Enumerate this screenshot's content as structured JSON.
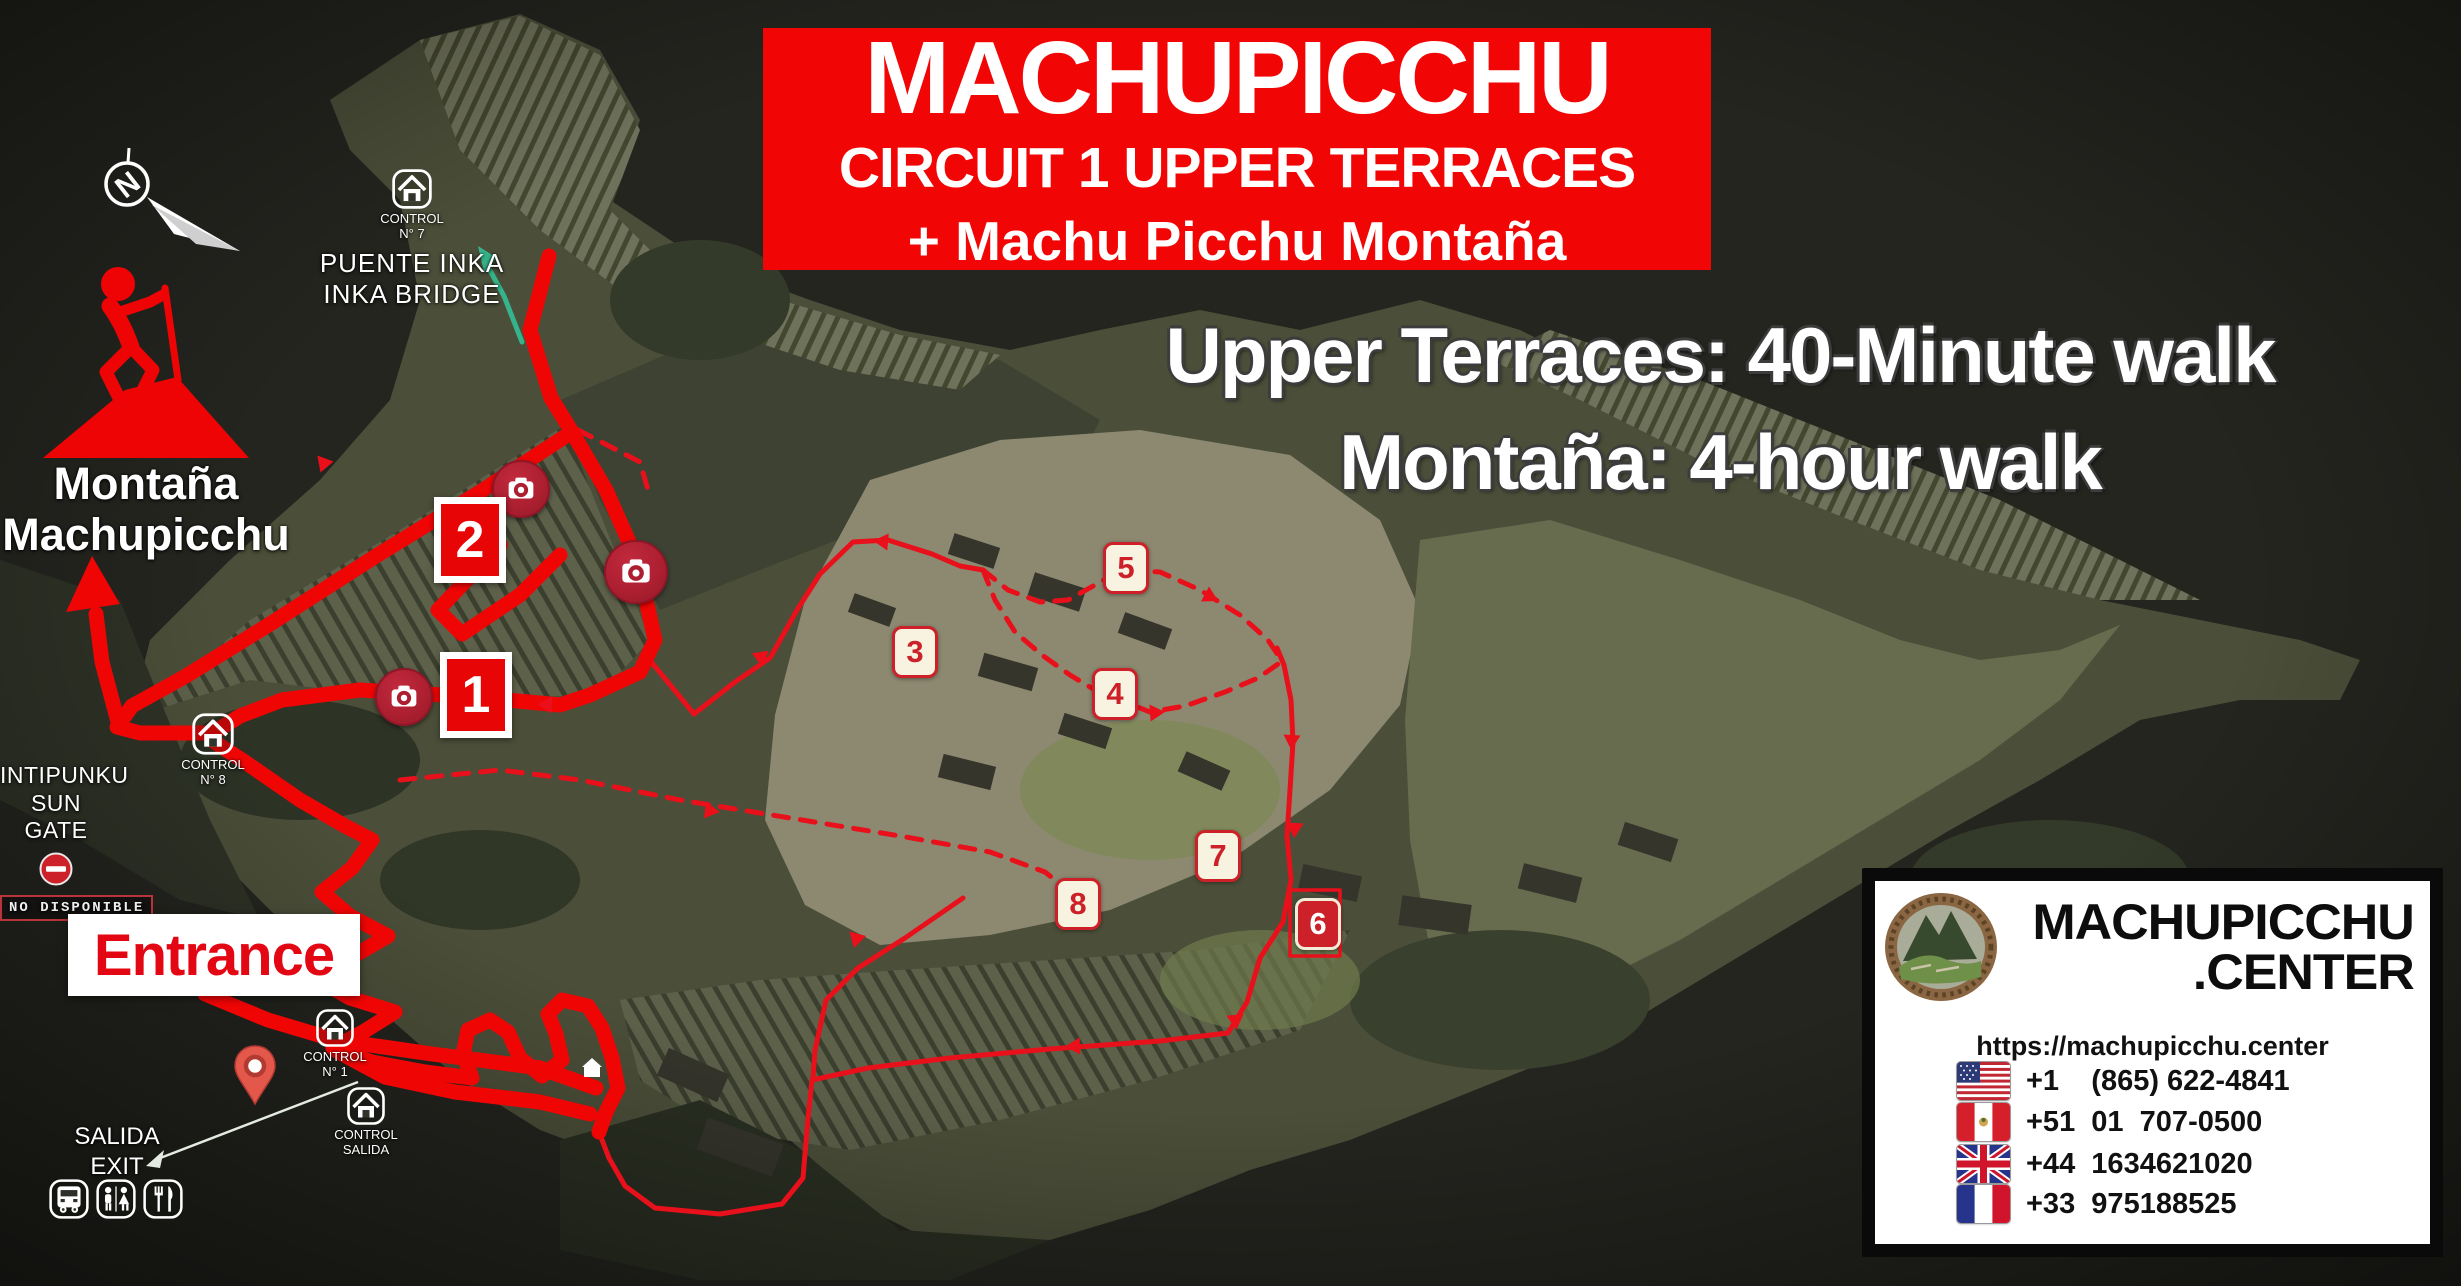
{
  "banner": {
    "title": "MACHUPICCHU",
    "subtitle": "CIRCUIT 1 UPPER TERRACES",
    "subtitle2": "+ Machu Picchu Montaña"
  },
  "walk_info": {
    "line1": "Upper Terraces: 40-Minute walk",
    "line2": "Montaña: 4-hour walk"
  },
  "compass": {
    "north_letter": "N"
  },
  "montana_peak": {
    "line1": "Montaña",
    "line2": "Machupicchu"
  },
  "inka_bridge": {
    "control_line1": "CONTROL",
    "control_line2": "N° 7",
    "name_line1": "PUENTE INKA",
    "name_line2": "INKA BRIDGE"
  },
  "sun_gate": {
    "name_line1": "INTIPUNKU",
    "name_line2": "SUN GATE",
    "status": "NO DISPONIBLE"
  },
  "control_8": {
    "line1": "CONTROL",
    "line2": "N° 8"
  },
  "control_1": {
    "line1": "CONTROL",
    "line2": "N° 1"
  },
  "control_salida": {
    "line1": "CONTROL",
    "line2": "SALIDA"
  },
  "entrance": {
    "label": "Entrance"
  },
  "exit": {
    "line1": "SALIDA",
    "line2": "EXIT"
  },
  "markers": [
    {
      "label": "1"
    },
    {
      "label": "2"
    },
    {
      "label": "3"
    },
    {
      "label": "4"
    },
    {
      "label": "5"
    },
    {
      "label": "6"
    },
    {
      "label": "7"
    },
    {
      "label": "8"
    }
  ],
  "facilities": {
    "icons": [
      "bus",
      "restrooms",
      "restaurant"
    ]
  },
  "info_box": {
    "brand_line1": "MACHUPICCHU",
    "brand_line2": ".CENTER",
    "url": "https://machupicchu.center",
    "phones": [
      {
        "flag": "usa",
        "number": "+1    (865) 622-4841"
      },
      {
        "flag": "peru",
        "number": "+51  01  707-0500"
      },
      {
        "flag": "uk",
        "number": "+44  1634621020"
      },
      {
        "flag": "france",
        "number": "+33  975188525"
      }
    ]
  },
  "colors": {
    "banner_red": "#f20505",
    "route_red": "#ee0a0a",
    "badge_red": "#cc2128",
    "badge_cream": "#f8f2e0",
    "entrance_red": "#e30613",
    "teal_path": "#35b38b"
  }
}
